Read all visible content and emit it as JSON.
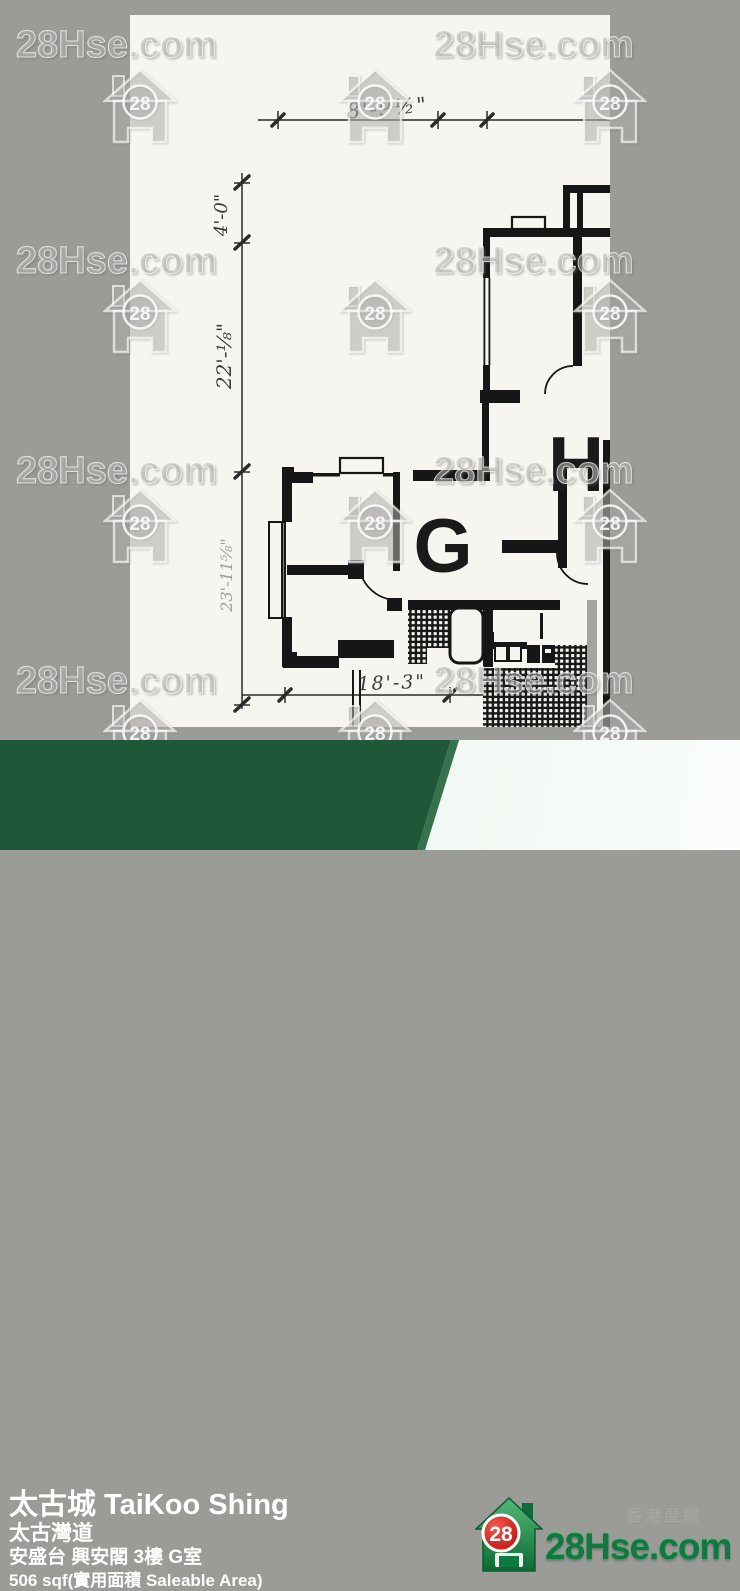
{
  "watermark": {
    "text": "28Hse.com",
    "logo_text": "28"
  },
  "plan": {
    "labels": {
      "unit_g": "G",
      "unit_h": "H"
    },
    "dims": {
      "top": "8'-9½\"",
      "left_top": "4'-0\"",
      "left_mid": "22'-⅛\"",
      "left_bottom": "23'-11⅝\"",
      "bottom": "18'-3\""
    }
  },
  "footer": {
    "title": "太古城 TaiKoo Shing",
    "street": "太古灣道",
    "address": "安盛台 興安閣 3樓 G室",
    "area": "506 sqf(實用面積 Saleable Area)"
  },
  "brand": {
    "tagline": "香港屋網",
    "site": "28Hse.com",
    "logo_text": "28"
  },
  "colors": {
    "background_gray": "#9b9b97",
    "footer_green": "#1e5838",
    "brand_green": "#10793f",
    "brand_red": "#c01212"
  }
}
